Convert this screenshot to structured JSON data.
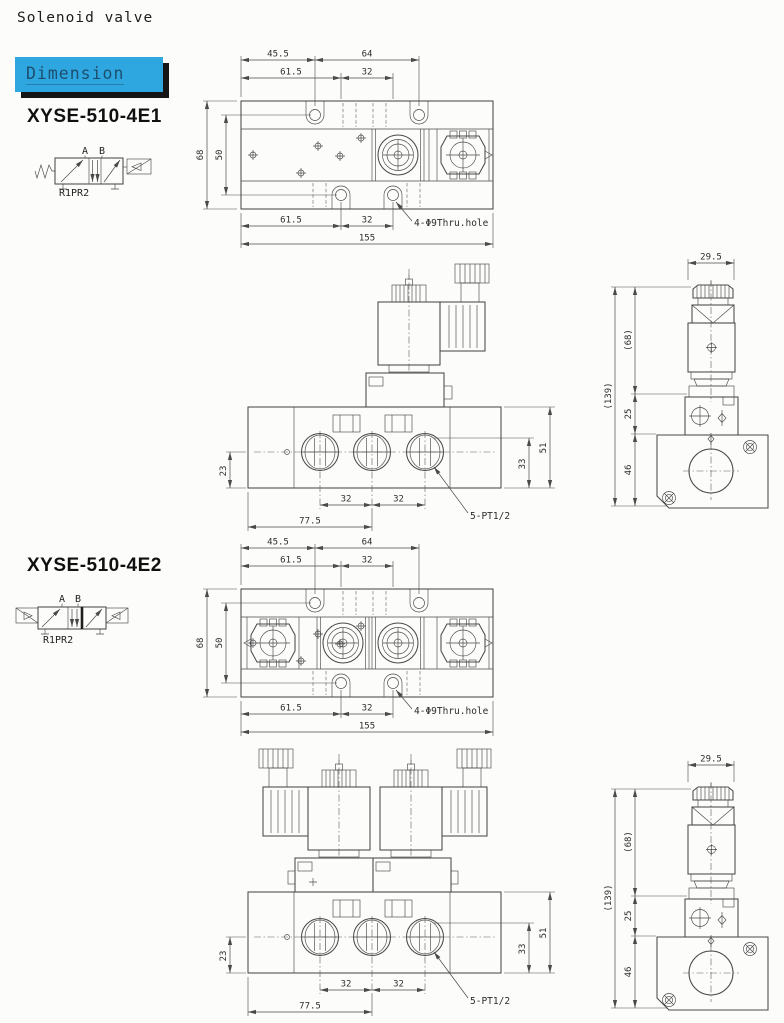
{
  "page": {
    "title": "Solenoid valve",
    "section_badge": "Dimension"
  },
  "colors": {
    "badge_bg": "#2ea7e0",
    "badge_text": "#1d4e6e",
    "badge_shadow": "#161616",
    "drawing_line": "#4a4a4a",
    "page_bg": "#fcfcfb"
  },
  "models": [
    {
      "name": "XYSE-510-4E1",
      "port_a": "A",
      "port_b": "B",
      "ports_bottom": "R1PR2"
    },
    {
      "name": "XYSE-510-4E2",
      "port_a": "A",
      "port_b": "B",
      "ports_bottom": "R1PR2"
    }
  ],
  "top_view": {
    "dim_45_5": "45.5",
    "dim_64": "64",
    "dim_61_5_top": "61.5",
    "dim_32_top": "32",
    "dim_68": "68",
    "dim_50": "50",
    "dim_61_5_bottom": "61.5",
    "dim_32_bottom": "32",
    "dim_155": "155",
    "thru_hole_label": "4-Φ9Thru.hole"
  },
  "front_view": {
    "dim_23": "23",
    "dim_51": "51",
    "dim_33": "33",
    "dim_32_left": "32",
    "dim_32_right": "32",
    "dim_77_5": "77.5",
    "port_label": "5-PT1/2"
  },
  "side_view": {
    "dim_29_5": "29.5",
    "dim_68_ref": "(68)",
    "dim_139_ref": "(139)",
    "dim_25": "25",
    "dim_46": "46"
  }
}
